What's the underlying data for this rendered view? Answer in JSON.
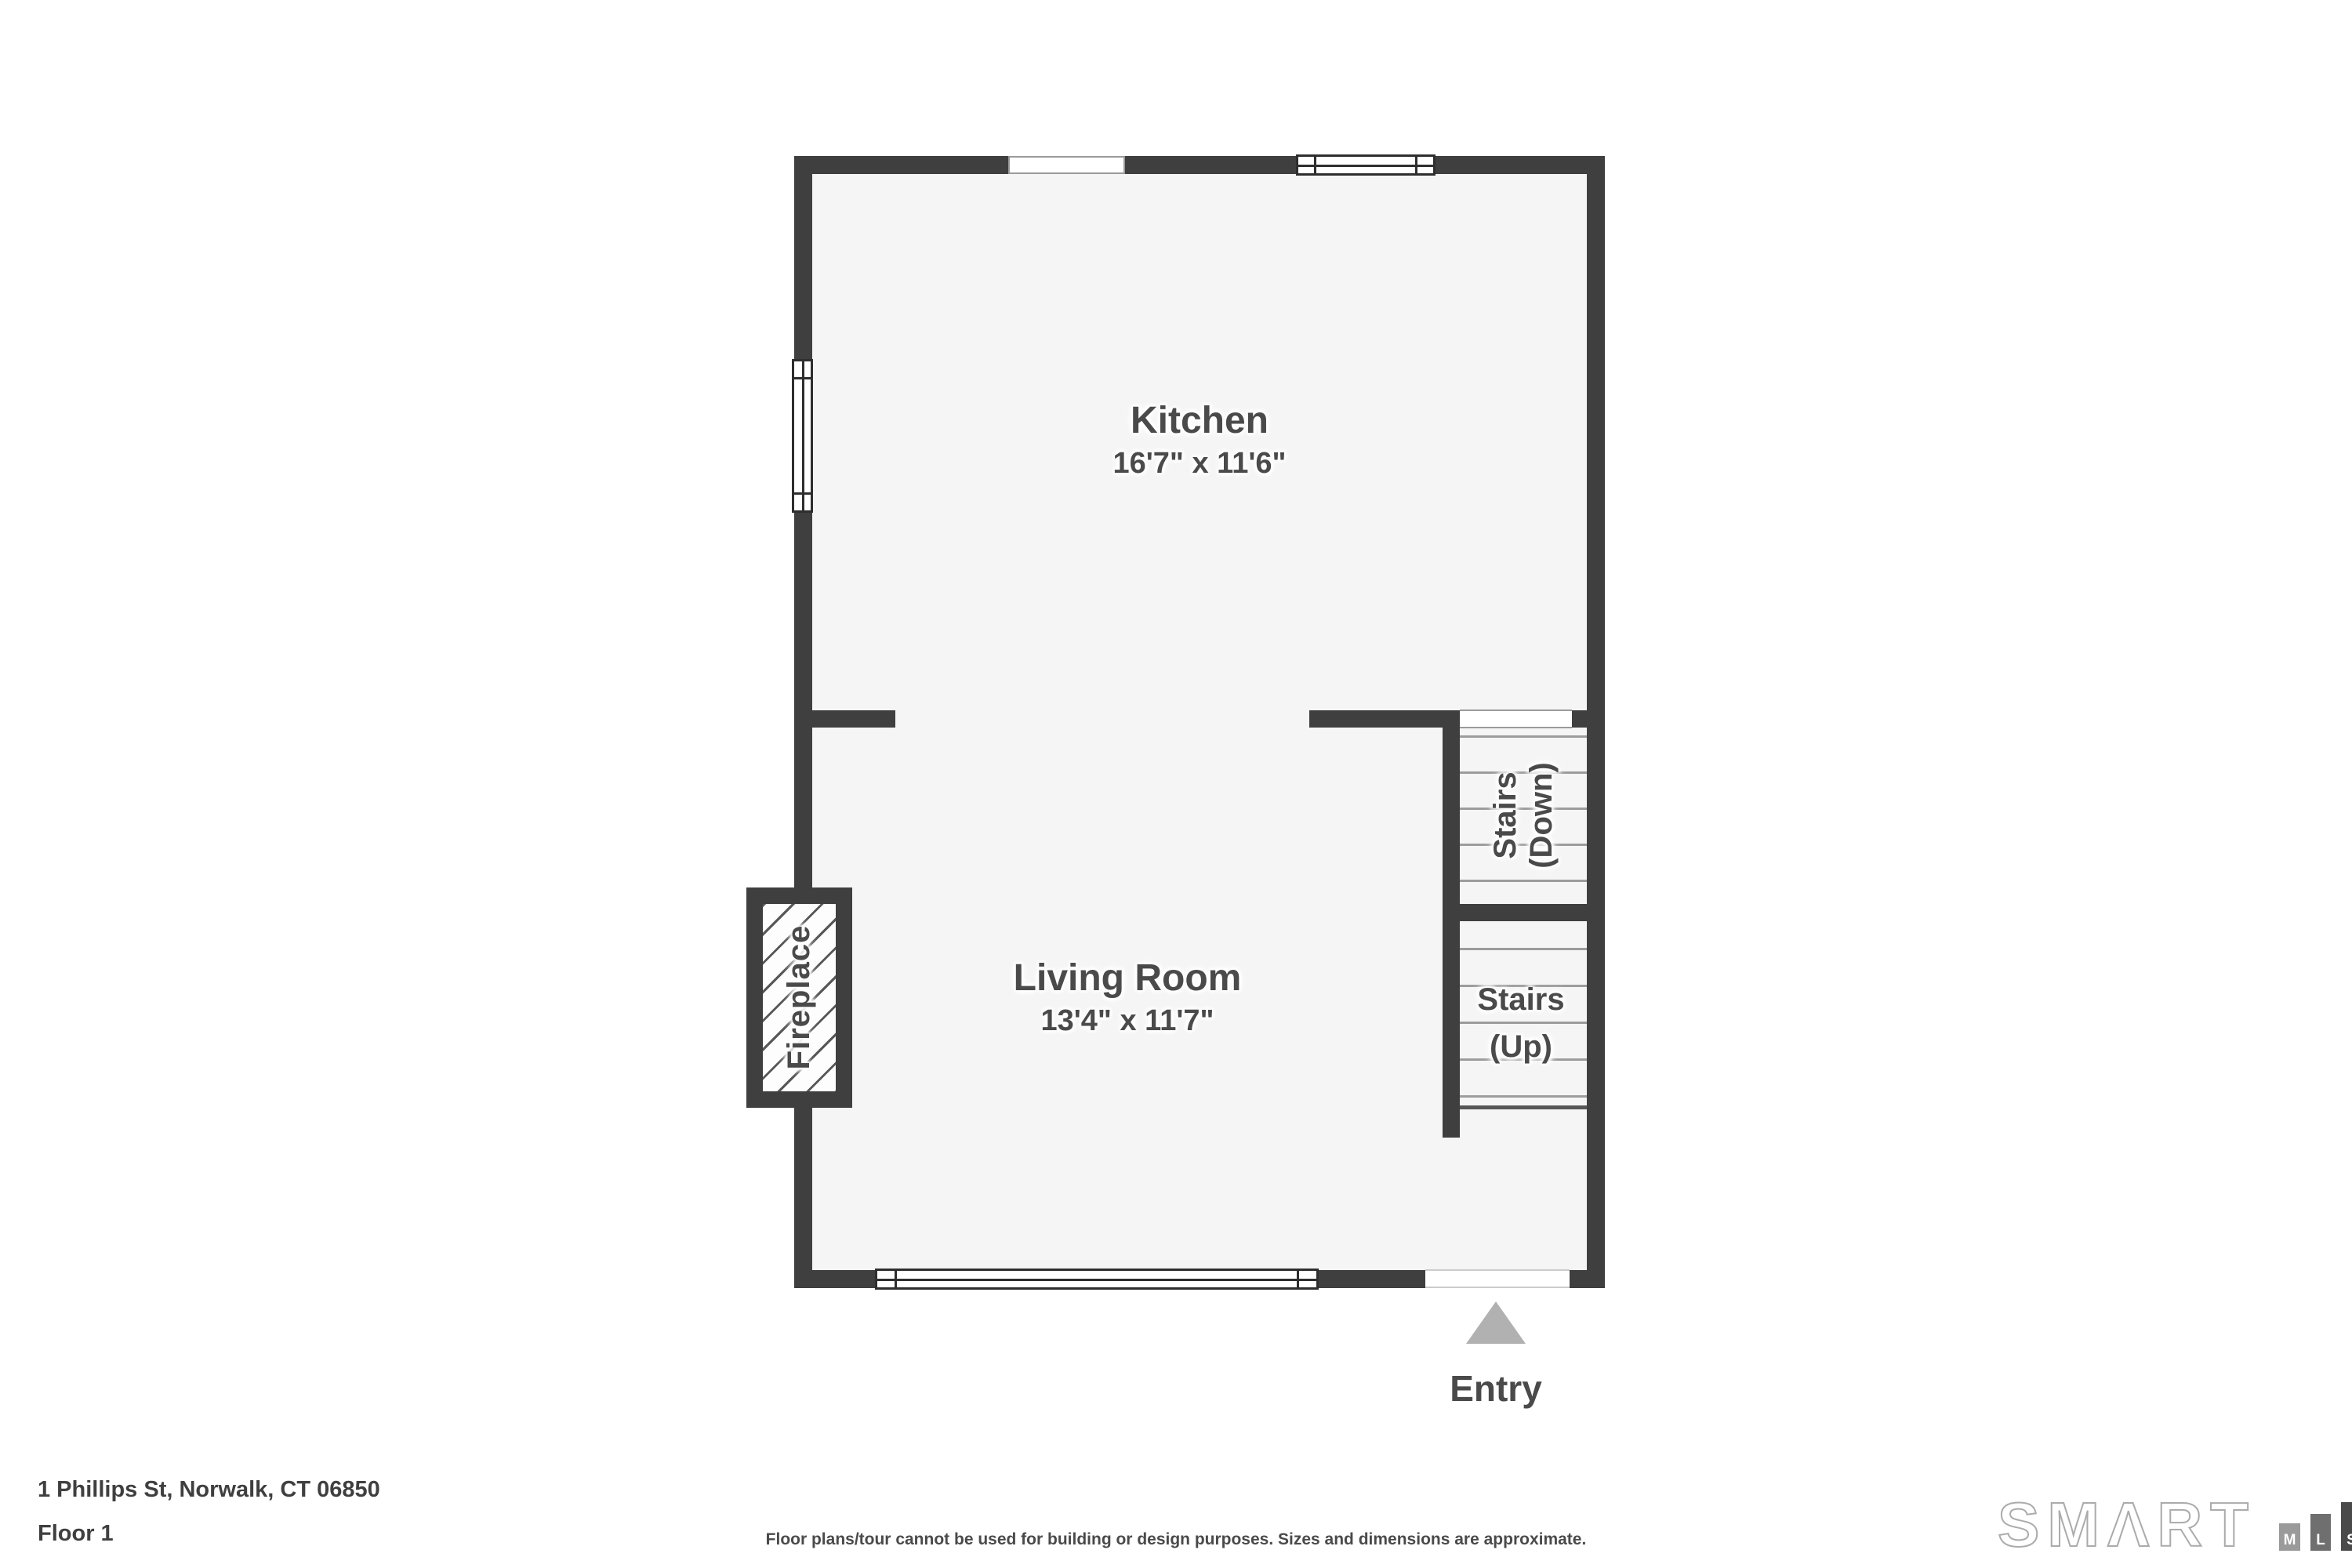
{
  "plan": {
    "rooms": [
      {
        "id": "kitchen",
        "name": "Kitchen",
        "dimensions": "16'7\" x 11'6\""
      },
      {
        "id": "living-room",
        "name": "Living Room",
        "dimensions": "13'4\" x 11'7\""
      }
    ],
    "stairs_down": {
      "line1": "Stairs",
      "line2": "(Down)"
    },
    "stairs_up": {
      "line1": "Stairs",
      "line2": "(Up)"
    },
    "fireplace": {
      "label": "Fireplace"
    },
    "entry": {
      "label": "Entry"
    }
  },
  "footer": {
    "address": "1 Phillips St, Norwalk, CT 06850",
    "floor": "Floor 1",
    "disclaimer": "Floor plans/tour cannot be used for building or design purposes. Sizes and dimensions are approximate."
  },
  "logo": {
    "brand": "SMΛRT",
    "marks": [
      "M",
      "L",
      "S"
    ]
  },
  "colors": {
    "wall": "#3f3f3f",
    "floor": "#f5f5f5",
    "text": "#4a4a4a",
    "tread_line": "#9c9c9c",
    "entry_triangle": "#b1b1b1",
    "logo_outline": "#ababab"
  }
}
